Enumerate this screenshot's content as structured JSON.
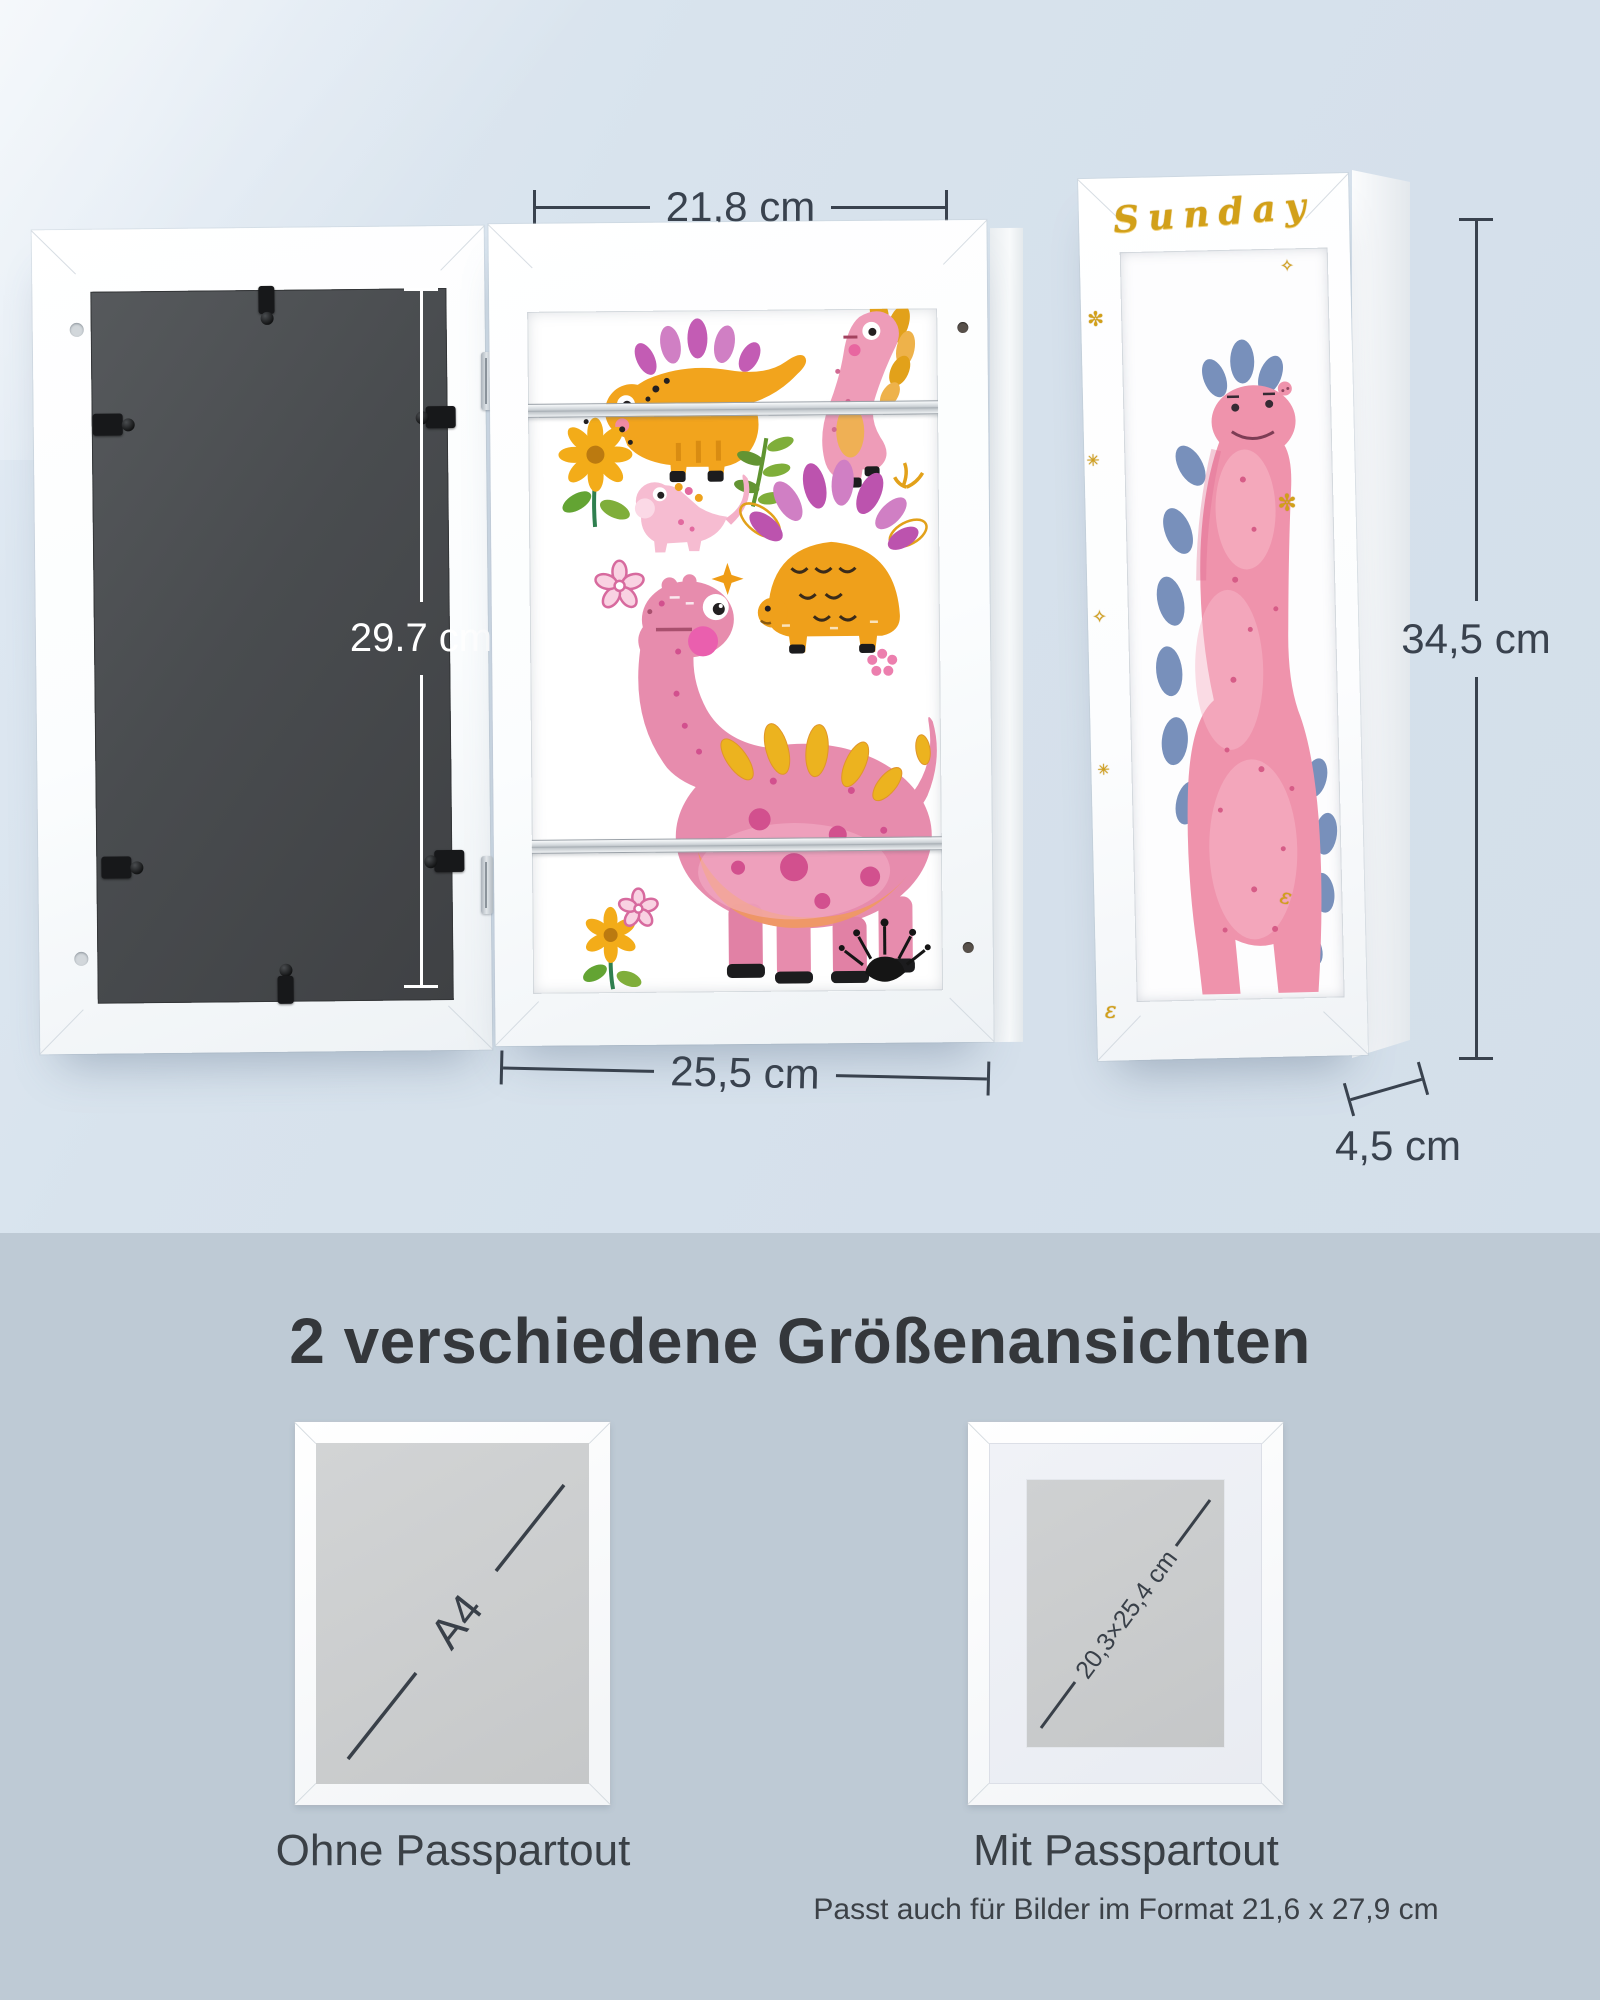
{
  "top_section": {
    "dimensions": {
      "inner_width": "21,8 cm",
      "back_height": "29.7 cm",
      "outer_width": "25,5 cm",
      "side_height": "34,5 cm",
      "depth": "4,5 cm"
    },
    "side_frame": {
      "handwriting": "Sunday",
      "decorations": [
        "✼",
        "✳",
        "✧",
        "✳",
        "ε",
        "✧",
        "✼",
        "ε"
      ]
    }
  },
  "bottom_section": {
    "heading": "2 verschiedene Größenansichten",
    "left_frame": {
      "diagonal_label": "A4",
      "caption": "Ohne Passpartout"
    },
    "right_frame": {
      "diagonal_label": "20,3×25,4 cm",
      "caption": "Mit Passpartout",
      "note": "Passt auch für Bilder im Format 21,6 x 27,9 cm"
    }
  },
  "colors": {
    "top_background": "#d8e3ed",
    "bottom_background": "#becad5",
    "dimension_text": "#39424e",
    "dimension_text_light": "#ffffff",
    "heading_text": "#34373b",
    "gold_accent": "#d2a019",
    "frame_white": "#fbfdfe",
    "back_panel": "#46494c"
  }
}
